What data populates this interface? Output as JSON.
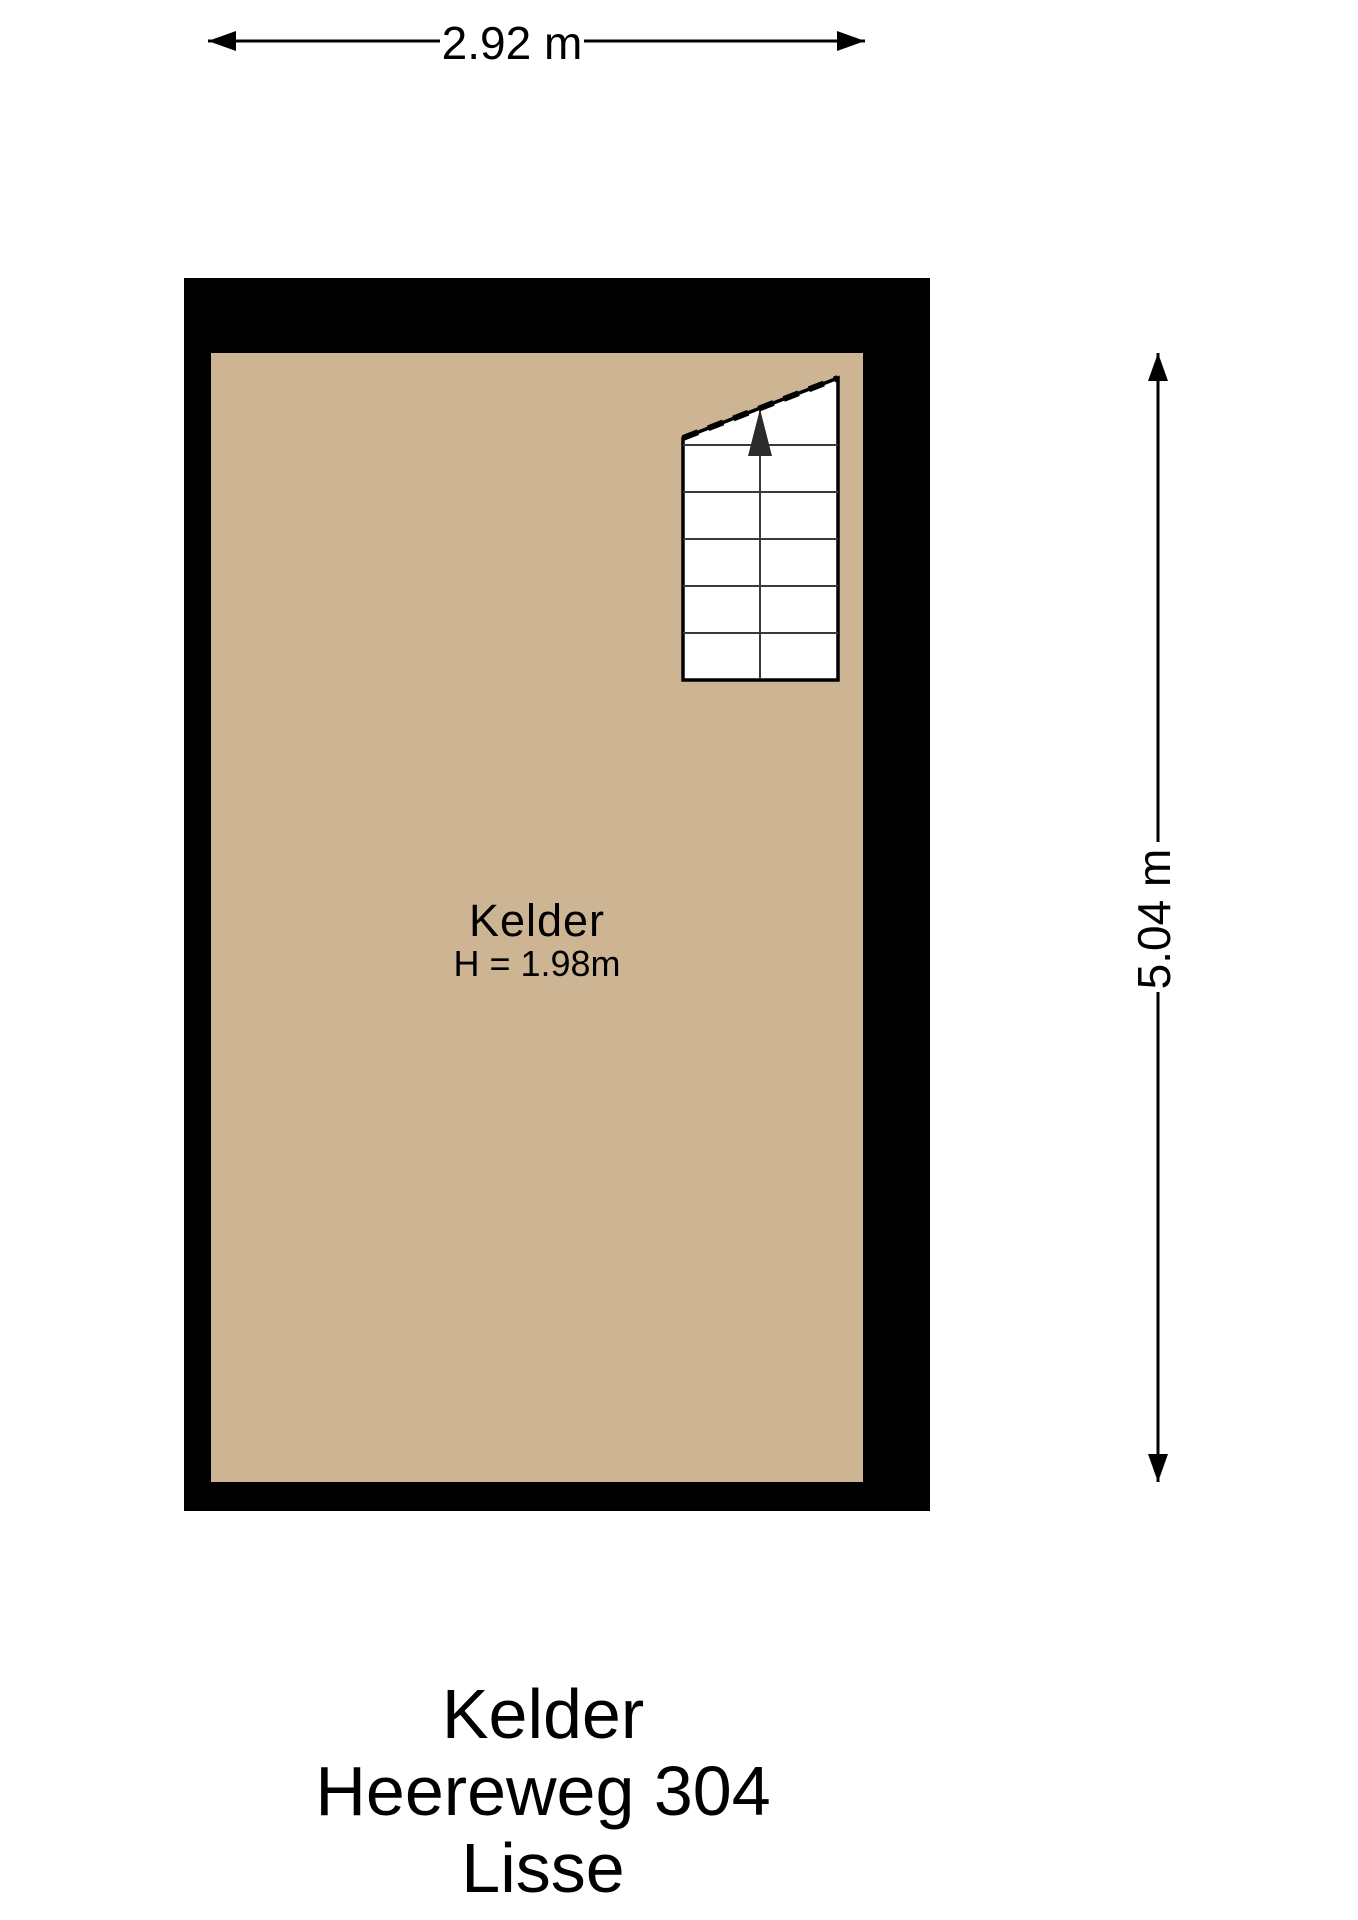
{
  "plan": {
    "room": {
      "name": "Kelder",
      "height_label": "H = 1.98m"
    },
    "dimensions": {
      "width": {
        "label": "2.92 m"
      },
      "height": {
        "label": "5.04 m"
      }
    },
    "stairs": {
      "visible_step_rows": 6,
      "direction": "up"
    }
  },
  "title_block": {
    "lines": [
      "Kelder",
      "Heereweg 304",
      "Lisse"
    ]
  },
  "colors": {
    "wall": "#000000",
    "floor": "#CDB492",
    "stair_fill": "#FFFFFF",
    "line": "#000000",
    "step_line": "#3a3a3a",
    "stair_arrow": "#2b2b2b"
  }
}
